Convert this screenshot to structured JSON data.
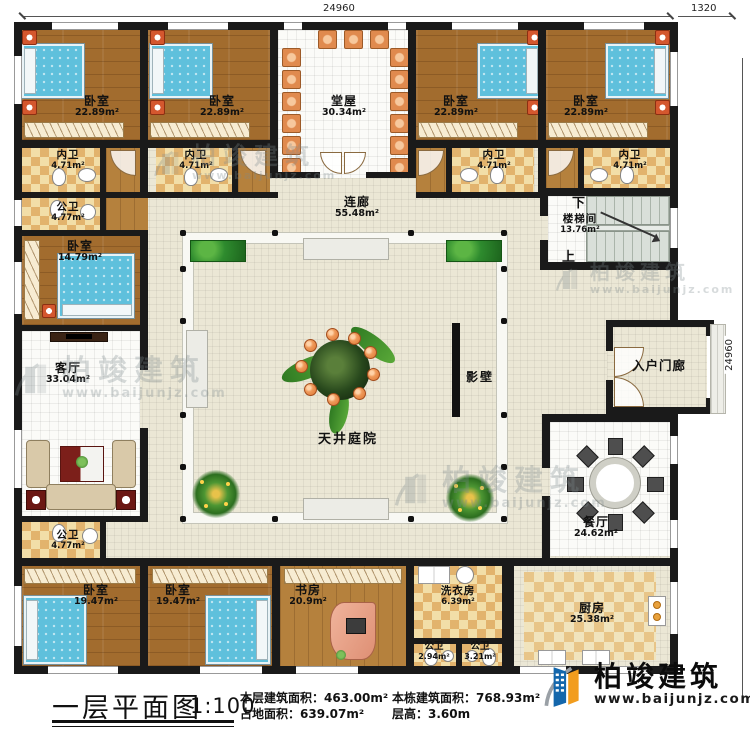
{
  "dimensions": {
    "top": "24960",
    "top_right": "1320",
    "right": "24960"
  },
  "watermark": {
    "name": "柏竣建筑",
    "url": "www.baijunjz.com"
  },
  "logo": {
    "name": "柏竣建筑",
    "url": "www.baijunjz.com"
  },
  "stairs": {
    "down": "下",
    "up": "上"
  },
  "legend": {
    "title": "一层平面图",
    "scale": "1:100",
    "stats": [
      {
        "label": "本层建筑面积：",
        "value": "463.00m²"
      },
      {
        "label": "占地面积：",
        "value": "639.07m²"
      },
      {
        "label": "本栋建筑面积：",
        "value": "768.93m²"
      },
      {
        "label": "层高：",
        "value": "3.60m"
      }
    ]
  },
  "rooms": [
    {
      "name": "卧室",
      "area": "22.89m²"
    },
    {
      "name": "卧室",
      "area": "22.89m²"
    },
    {
      "name": "堂屋",
      "area": "30.34m²"
    },
    {
      "name": "卧室",
      "area": "22.89m²"
    },
    {
      "name": "卧室",
      "area": "22.89m²"
    },
    {
      "name": "内卫",
      "area": "4.71m²"
    },
    {
      "name": "内卫",
      "area": "4.71m²"
    },
    {
      "name": "内卫",
      "area": "4.71m²"
    },
    {
      "name": "内卫",
      "area": "4.71m²"
    },
    {
      "name": "公卫",
      "area": "4.77m²"
    },
    {
      "name": "连廊",
      "area": "55.48m²"
    },
    {
      "name": "楼梯间",
      "area": "13.76m²"
    },
    {
      "name": "卧室",
      "area": "14.79m²"
    },
    {
      "name": "客厅",
      "area": "33.04m²"
    },
    {
      "name": "影壁",
      "area": ""
    },
    {
      "name": "天井庭院",
      "area": ""
    },
    {
      "name": "入户门廊",
      "area": ""
    },
    {
      "name": "餐厅",
      "area": "24.62m²"
    },
    {
      "name": "公卫",
      "area": "4.77m²"
    },
    {
      "name": "卧室",
      "area": "19.47m²"
    },
    {
      "name": "卧室",
      "area": "19.47m²"
    },
    {
      "name": "书房",
      "area": "20.9m²"
    },
    {
      "name": "洗衣房",
      "area": "6.39m²"
    },
    {
      "name": "公卫",
      "area": "2.94m²"
    },
    {
      "name": "公卫",
      "area": "3.21m²"
    },
    {
      "name": "厨房",
      "area": "25.38m²"
    }
  ]
}
